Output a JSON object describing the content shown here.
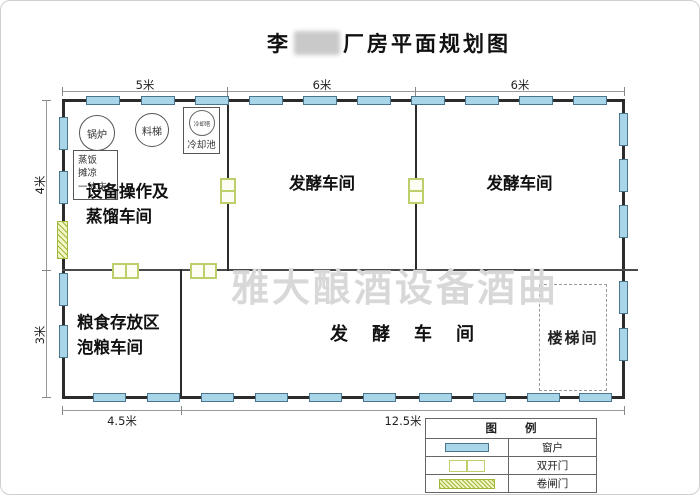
{
  "title": {
    "name_prefix": "李",
    "name_suffix": "厂房平面规划图"
  },
  "watermark": "雅大酿酒设备酒曲",
  "rooms": {
    "equipment": "设备操作及\n蒸馏车间",
    "ferment_top_left": "发酵车间",
    "ferment_top_right": "发酵车间",
    "grain": "粮食存放区\n泡粮车间",
    "ferment_bottom": "发酵车间",
    "stairwell": "楼梯间"
  },
  "equipment": {
    "boiler": "锅炉",
    "material_hoist": "料梯",
    "cooling_tower": "冷却塔",
    "cooling_pool": "冷却池",
    "steam_cool_bed": "蒸饭\n摊凉\n一体床"
  },
  "dimensions": {
    "top": [
      "5米",
      "6米",
      "6米"
    ],
    "left": [
      "4米",
      "3米"
    ],
    "bottom": [
      "4.5米",
      "12.5米"
    ]
  },
  "legend": {
    "title": "图 例",
    "items": [
      {
        "symbol": "window",
        "label": "窗户"
      },
      {
        "symbol": "double-door",
        "label": "双开门"
      },
      {
        "symbol": "roller-door",
        "label": "卷闸门"
      }
    ]
  },
  "colors": {
    "wall": "#2b2b2b",
    "window_fill": "#a9d5e8",
    "window_border": "#49768c",
    "door_green": "#bccf6a",
    "roller_fill": "#f4f5c6",
    "watermark": "#d8d8d8"
  }
}
